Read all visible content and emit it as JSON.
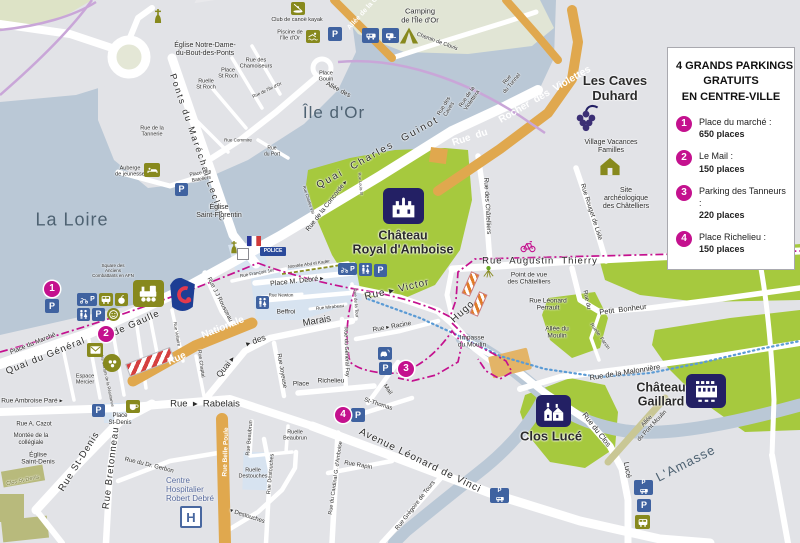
{
  "legend": {
    "title": "4 GRANDS PARKINGS\nGRATUITS\nEN CENTRE-VILLE",
    "items": [
      {
        "num": "1",
        "name": "Place du marché :",
        "places": "650 places"
      },
      {
        "num": "2",
        "name": "Le Mail :",
        "places": "150 places"
      },
      {
        "num": "3",
        "name": "Parking des Tanneurs :",
        "places": "220 places"
      },
      {
        "num": "4",
        "name": "Place Richelieu :",
        "places": "150 places"
      }
    ]
  },
  "icon_labels": {
    "parking": "P",
    "hospital": "H",
    "police": "POLICE"
  },
  "colors": {
    "accent_magenta": "#c4118e",
    "parking_blue": "#3f62a0",
    "attraction_navy": "#232064",
    "poi_olive": "#87891d",
    "street_orange": "#e0a84e",
    "park_green": "#a6c93e",
    "water": "#bac8d6"
  },
  "labels": {
    "eglise_nd": "Église Notre-Dame-\ndu-Bout-des-Ponts",
    "club_kayak": "Club de canoë kayak",
    "piscine": "Piscine de\nl'Île d'Or",
    "camping": "Camping\nde l'Île d'Or",
    "chemin_clovis": "Chemin de Clovis",
    "allee_de_la": "Allée de la C",
    "ponts_marechal": "Ponts du Maréchal Leclerc",
    "ruelle_st_roch": "Ruelle\nSt Roch",
    "place_st_roch": "Place\nSt Roch",
    "rue_chamoiseurs": "Rue des\nChamoiseurs",
    "place_gouin": "Place\nGouin",
    "allee_des": "Allée des",
    "ile_dor": "Île d'Or",
    "rue_ile_dor": "Rue de l'Île d'Or",
    "rue_commire": "Rue Commire",
    "rue_du_port": "Rue\ndu Port",
    "rue_tannerie": "Rue de la\nTannerie",
    "auberge": "Auberge\nde jeunesse",
    "place_bateliers": "Place des\nBateliers",
    "la_loire": "La Loire",
    "eglise_florentin": "Église\nSaint-Florentin",
    "square_afn": "Square des\nAnciens\nCombattants en AFN",
    "quai_general": "Quai du Général",
    "de_gaulle": "de Gaulle",
    "place_marche": "Place du Marché",
    "espace_mercier": "Espace\nMercier",
    "martyrs": "A. des Martyrs de la Résistance",
    "rue_ambroise_pare": "Rue Ambroise Paré ▸",
    "rue_cazot": "Rue A. Cazot",
    "montee_collegiale": "Montée de la\ncollégiale",
    "eglise_st_denis": "Église\nSaint-Denis",
    "clos_st_denis": "Clos St-Denis",
    "rue_st_denis": "Rue St-Denis",
    "rue_bretonneau": "Rue Bretonneau",
    "place_st_denis": "Place\nSt-Denis",
    "rue_dr_gerbon": "Rue du Dr. Gerbon",
    "hopital": "Centre\nHospitalier\nRobert Debré",
    "rue_rabelais": "Rue  ▸  Rabelais",
    "rue_belle_poule": "Rue Belle Poule",
    "rue_beaubrun": "Rue Beaubrun",
    "ruelle_beaubrun": "Ruelle\nBeaubrun",
    "ruelle_destouches": "Ruelle\nDestouches",
    "rue_destouches": "Rue Destouches",
    "destouches": "▾ Destouches",
    "rue_cardinal": "Rue du Cardinal G. d'Amboise",
    "av_vinci": "Avenue Léonard de Vinci",
    "rue_rapin": "Rue Rapin",
    "rue_gregoire": "Rue Grégoire de Tours",
    "st_thomas": "St-Thomas",
    "mail": "Mail",
    "place_lbl": "Place",
    "richelieu": "Richelieu",
    "rue_joyeuse": "Rue Joyeuse",
    "quai_diag": "Quai ▸",
    "des_diag": "▸ des",
    "marais": "Marais",
    "rue_general_foy": "Rue du Général Foy",
    "rue_tour": "Rue de la Tour",
    "rue_racine": "Rue ▸ Racine",
    "rue_chaptal": "Rue Chaptal",
    "rue_voltaire": "Rue Voltaire",
    "rue_nationale_a": "Rue",
    "rue_nationale_b": "Nationale",
    "jj_rousseau": "Rue J.J Rousseau",
    "francois1": "Rue François 1er",
    "montee_abd": "Montée Abd el Kader",
    "place_debre": "Place M. Debré ▸",
    "rue_newton": "Rue Newton",
    "beffroi": "Beffroi",
    "rue_mirabeau": "Rue Mirabeau",
    "chateau_royal": "Château\nRoyal d'Amboise",
    "quai_guinot": "Quai  Charles  Guinot",
    "rue_concorde": "Rue de la Concorde ▸",
    "rue_louis": "Rue Louis XI",
    "rue_charles8": "Rue Charles VIII",
    "rue_caves": "Rue des\nCaves",
    "rue_violettera": "Rue de la\nViolettera",
    "rue_tunnel": "Rue\ndu Tunnel",
    "rue_du_o": "Rue  du",
    "rocher": "Rocher  des  Violettes",
    "caves_duhard": "Les Caves\nDuhard",
    "vvf": "Village Vacances\nFamilles",
    "site_archeo": "Site\narchéologique\ndes Châtelliers",
    "rue_chatelliers": "Rue des Châtelliers",
    "rue_rouget": "Rue Rouget de Lisle",
    "rue_augustin": "Rue  Augustin  Thierry",
    "point_vue": "Point de vue\ndes Châtelliers",
    "rue_perrault": "Rue Léonard\nPerrault",
    "petit_bonheur": "Petit  Bonheur",
    "rue_du_pb": "Rue du",
    "ruelle_farcin": "Ruelle  Farcin",
    "impasse_moulin": "Impasse\ndu Moulin",
    "allee_moulin": "Allée du\nMoulin",
    "malonniere": "Rue de la Malonnière",
    "gaillard": "Château\nGaillard",
    "clos_luce": "Clos Lucé",
    "rue_du_clos": "Rue du Clos",
    "luce_v": "Lucé",
    "allee_pont_moulin": "Allée\ndu Pont Moulin",
    "lamasse": "L'Amasse",
    "hugo": "Hugo",
    "rue_victor": "Rue ▸ Victor"
  }
}
